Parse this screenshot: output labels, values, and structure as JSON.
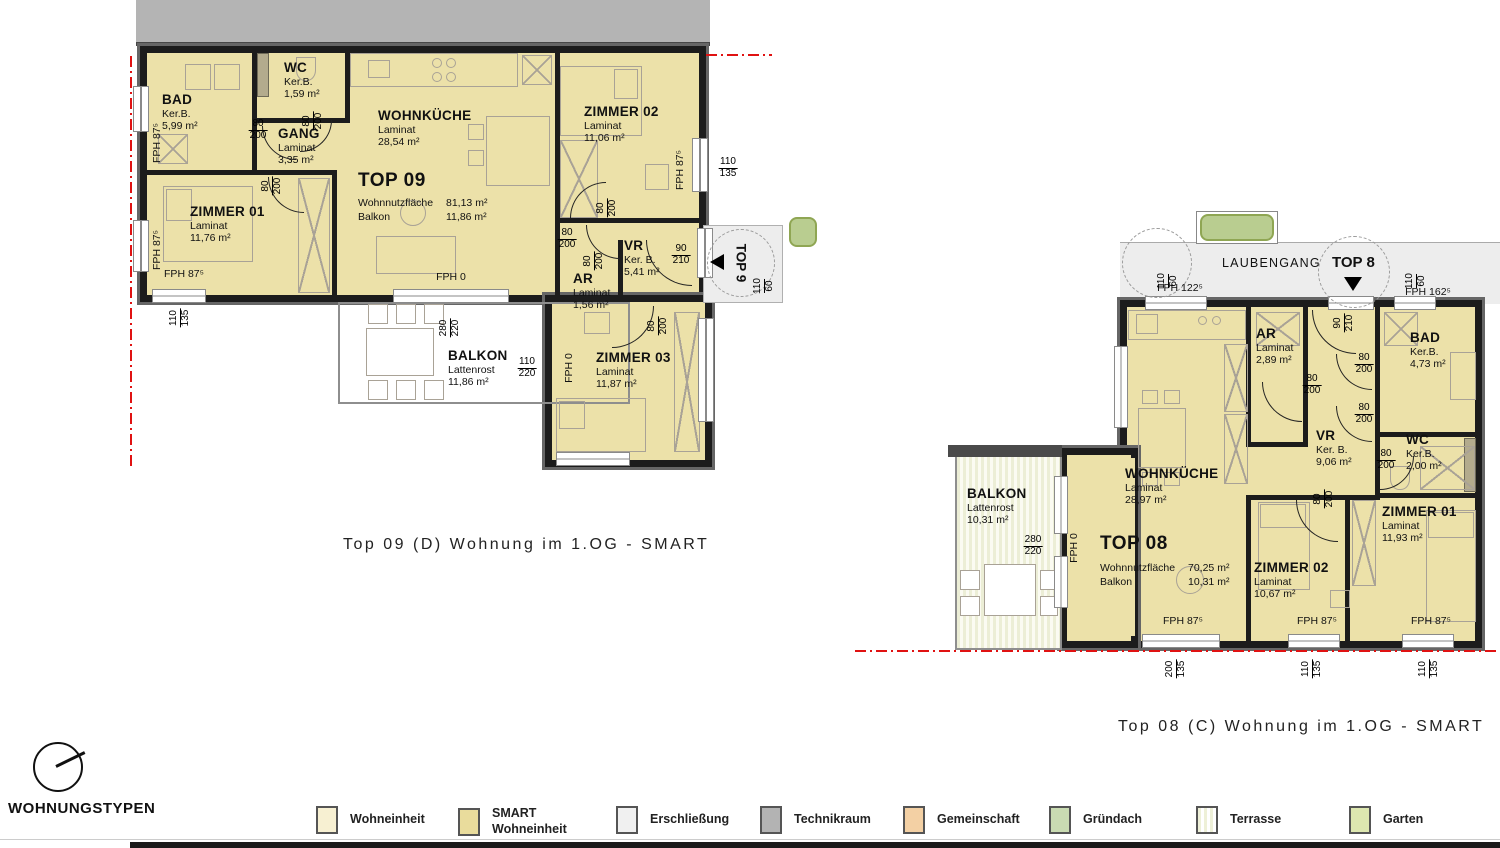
{
  "colors": {
    "smart_fill": "#ece1a9",
    "wall": "#1c1c1c",
    "roof_gray": "#b4b4b4",
    "circulation": "#ededed",
    "red_line": "#e01212",
    "green_roof": "#b9cd90"
  },
  "laubengang_label": "LAUBENGANG",
  "wohnungstypen_heading": "WOHNUNGSTYPEN",
  "top09": {
    "title": "Top 09 (D) Wohnung im 1.OG - SMART",
    "unit": "TOP 09",
    "entry_label": "TOP 9",
    "stats": {
      "l1": "Wohnnutzfläche",
      "v1": "81,13 m²",
      "l2": "Balkon",
      "v2": "11,86 m²"
    },
    "rooms": {
      "bad": {
        "name": "BAD",
        "mat": "Ker.B.",
        "area": "5,99 m²"
      },
      "wc": {
        "name": "WC",
        "mat": "Ker.B.",
        "area": "1,59 m²"
      },
      "gang": {
        "name": "GANG",
        "mat": "Laminat",
        "area": "3,35 m²"
      },
      "wohnkueche": {
        "name": "WOHNKÜCHE",
        "mat": "Laminat",
        "area": "28,54 m²"
      },
      "zimmer01": {
        "name": "ZIMMER 01",
        "mat": "Laminat",
        "area": "11,76 m²"
      },
      "zimmer02": {
        "name": "ZIMMER 02",
        "mat": "Laminat",
        "area": "11,06 m²"
      },
      "zimmer03": {
        "name": "ZIMMER 03",
        "mat": "Laminat",
        "area": "11,87 m²"
      },
      "ar": {
        "name": "AR",
        "mat": "Laminat",
        "area": "1,56 m²"
      },
      "vr": {
        "name": "VR",
        "mat": "Ker. B.",
        "area": "5,41 m²"
      },
      "balkon": {
        "name": "BALKON",
        "mat": "Lattenrost",
        "area": "11,86 m²"
      }
    },
    "fph": {
      "f1": "FPH 87⁵",
      "f2": "FPH 87⁵",
      "f3": "FPH 87⁵",
      "f4": "FPH 87⁵",
      "f5": "FPH 0",
      "f6": "FPH 0"
    },
    "dims": {
      "d1": {
        "a": "80",
        "b": "200"
      },
      "d2": {
        "a": "80",
        "b": "200"
      },
      "d3": {
        "a": "80",
        "b": "200"
      },
      "d4": {
        "a": "80",
        "b": "200"
      },
      "d5": {
        "a": "80",
        "b": "200"
      },
      "d6": {
        "a": "80",
        "b": "200"
      },
      "d7": {
        "a": "90",
        "b": "210"
      },
      "d8": {
        "a": "80",
        "b": "200"
      },
      "d9": {
        "a": "110",
        "b": "135"
      },
      "d10": {
        "a": "110",
        "b": "135"
      },
      "d11": {
        "a": "110",
        "b": "60"
      },
      "d12": {
        "a": "280",
        "b": "220"
      },
      "d13": {
        "a": "110",
        "b": "220"
      }
    }
  },
  "top08": {
    "title": "Top 08 (C) Wohnung im 1.OG - SMART",
    "unit": "TOP 08",
    "entry_label": "TOP 8",
    "stats": {
      "l1": "Wohnnutzfläche",
      "v1": "70,25 m²",
      "l2": "Balkon",
      "v2": "10,31 m²"
    },
    "rooms": {
      "wohnkueche": {
        "name": "WOHNKÜCHE",
        "mat": "Laminat",
        "area": "28,97 m²"
      },
      "ar": {
        "name": "AR",
        "mat": "Laminat",
        "area": "2,89 m²"
      },
      "vr": {
        "name": "VR",
        "mat": "Ker. B.",
        "area": "9,06 m²"
      },
      "bad": {
        "name": "BAD",
        "mat": "Ker.B.",
        "area": "4,73 m²"
      },
      "wc": {
        "name": "WC",
        "mat": "Ker.B.",
        "area": "2,00 m²"
      },
      "zimmer01": {
        "name": "ZIMMER 01",
        "mat": "Laminat",
        "area": "11,93 m²"
      },
      "zimmer02": {
        "name": "ZIMMER 02",
        "mat": "Laminat",
        "area": "10,67 m²"
      },
      "balkon": {
        "name": "BALKON",
        "mat": "Lattenrost",
        "area": "10,31 m²"
      }
    },
    "fph": {
      "g1": "FPH 122⁵",
      "g2": "FPH 162⁵",
      "g3": "FPH 0",
      "g4": "FPH 87⁵",
      "g5": "FPH 87⁵",
      "g6": "FPH 87⁵"
    },
    "dims": {
      "e1": {
        "a": "110",
        "b": "60"
      },
      "e2": {
        "a": "110",
        "b": "60"
      },
      "e3": {
        "a": "90",
        "b": "210"
      },
      "e4": {
        "a": "80",
        "b": "200"
      },
      "e5": {
        "a": "80",
        "b": "200"
      },
      "e6": {
        "a": "80",
        "b": "200"
      },
      "e7": {
        "a": "80",
        "b": "200"
      },
      "e8": {
        "a": "80",
        "b": "200"
      },
      "e9": {
        "a": "280",
        "b": "220"
      },
      "e10": {
        "a": "200",
        "b": "135"
      },
      "e11": {
        "a": "110",
        "b": "135"
      },
      "e12": {
        "a": "110",
        "b": "135"
      }
    }
  },
  "legend": {
    "items": [
      {
        "label": "Wohneinheit",
        "color": "#f7f0d2"
      },
      {
        "label": "SMART",
        "label2": "Wohneinheit",
        "color": "#e9dc9c"
      },
      {
        "label": "Erschließung",
        "color": "#f0f0f0"
      },
      {
        "label": "Technikraum",
        "color": "#b3b3b3"
      },
      {
        "label": "Gemeinschaft",
        "color": "#f3d0a4"
      },
      {
        "label": "Gründach",
        "color": "#c9dbb2"
      },
      {
        "label": "Terrasse",
        "color": "#eef0d8",
        "pattern": "striped"
      },
      {
        "label": "Garten",
        "color": "#dde7b0"
      }
    ]
  }
}
